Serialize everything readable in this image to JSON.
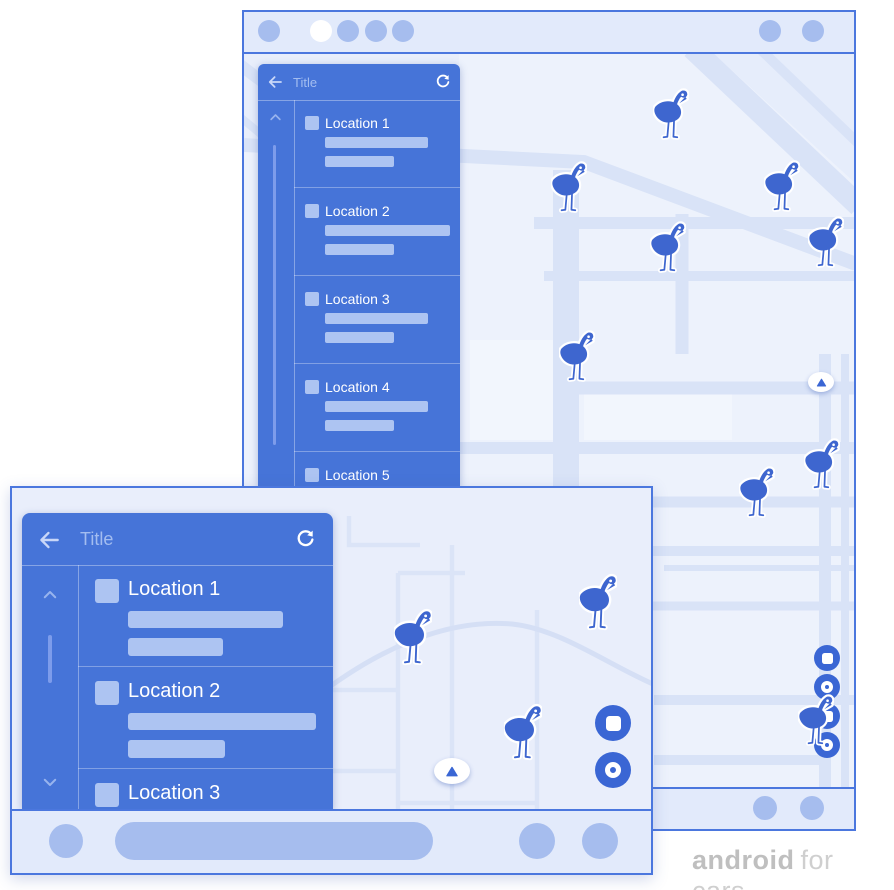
{
  "colors": {
    "panel_blue": "#4674d8",
    "frame_border": "#4b77de",
    "bezel": "#e2eafb",
    "map_background_portrait": "#edf2fc",
    "map_background_landscape": "#e9eefb",
    "map_road": "#d9e3f7",
    "placeholder_light": "#adc4f2",
    "dot_light": "#a6bdee",
    "marker_blue": "#3e66cf",
    "button_blue": "#3a66d4",
    "active_dot": "#ffffff",
    "watermark_gray": "#c8c8c8"
  },
  "portrait_screen": {
    "status_bar": {
      "left_dot_count": 5,
      "active_dot_index": 1,
      "right_dot_count": 2
    },
    "panel": {
      "title": "Title",
      "back_icon": "arrow-left-icon",
      "refresh_icon": "refresh-icon",
      "scroll_up_icon": "chevron-up-icon",
      "items": [
        {
          "label": "Location 1"
        },
        {
          "label": "Location 2"
        },
        {
          "label": "Location 3"
        },
        {
          "label": "Location 4"
        },
        {
          "label": "Location 5"
        }
      ]
    },
    "map": {
      "marker_icon": "flamingo-icon",
      "marker_count": 9,
      "compass_icon": "navigation-arrow-icon",
      "action_buttons": [
        {
          "icon": "square-icon"
        },
        {
          "icon": "circle-icon"
        },
        {
          "icon": "square-icon"
        },
        {
          "icon": "circle-icon"
        }
      ]
    },
    "bottom_bar": {
      "dot_count": 2
    }
  },
  "landscape_screen": {
    "panel": {
      "title": "Title",
      "back_icon": "arrow-left-icon",
      "refresh_icon": "refresh-icon",
      "scroll_up_icon": "chevron-up-icon",
      "scroll_down_icon": "chevron-down-icon",
      "items": [
        {
          "label": "Location 1"
        },
        {
          "label": "Location 2"
        },
        {
          "label": "Location 3"
        }
      ]
    },
    "map": {
      "marker_icon": "flamingo-icon",
      "marker_count": 3,
      "compass_icon": "navigation-arrow-icon",
      "action_buttons": [
        {
          "icon": "square-icon"
        },
        {
          "icon": "circle-icon"
        }
      ]
    },
    "bottom_bar": {
      "left_dot_count": 1,
      "pill": true,
      "right_dot_count": 2
    }
  },
  "watermark": {
    "brand": "android",
    "suffix": "for cars"
  }
}
